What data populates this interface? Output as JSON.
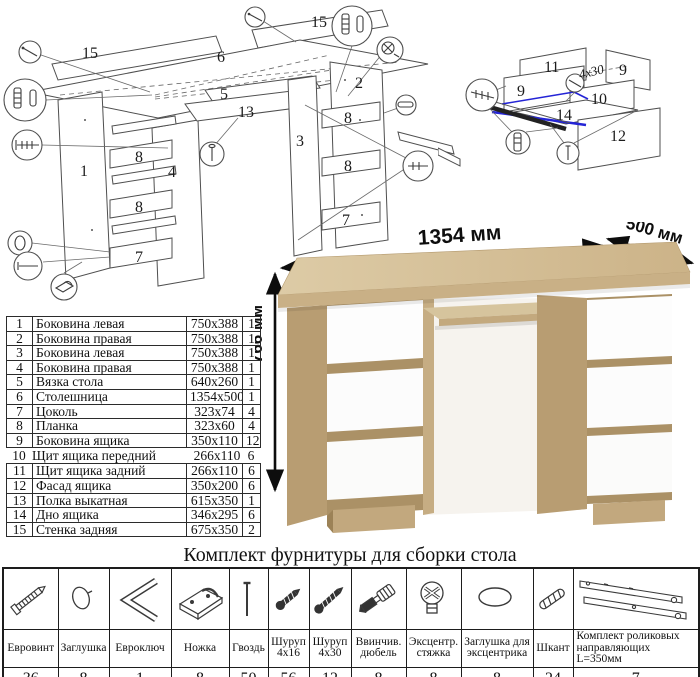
{
  "main_diagram": {
    "labels": {
      "p15_left": "15",
      "p15_right": "15",
      "p6": "6",
      "p5": "5",
      "p13": "13",
      "p1": "1",
      "p2": "2",
      "p3": "3",
      "p4": "4",
      "p7_left": "7",
      "p7_right": "7",
      "p8_a": "8",
      "p8_b": "8",
      "p8_c": "8",
      "p8_d": "8"
    }
  },
  "drawer_diagram": {
    "labels": {
      "p9_left": "9",
      "p9_right": "9",
      "p10": "10",
      "p11": "11",
      "p12": "12",
      "p14": "14",
      "screw_note": "4x30"
    }
  },
  "desk_view": {
    "dim_width": "1354 мм",
    "dim_depth": "500 мм",
    "dim_height": "766 мм"
  },
  "parts_table": {
    "rows": [
      {
        "num": "1",
        "name": "Боковина левая",
        "size": "750x388",
        "qty": "1"
      },
      {
        "num": "2",
        "name": "Боковина правая",
        "size": "750x388",
        "qty": "1"
      },
      {
        "num": "3",
        "name": "Боковина левая",
        "size": "750x388",
        "qty": "1"
      },
      {
        "num": "4",
        "name": "Боковина правая",
        "size": "750x388",
        "qty": "1"
      },
      {
        "num": "5",
        "name": "Вязка стола",
        "size": "640x260",
        "qty": "1"
      },
      {
        "num": "6",
        "name": "Столешница",
        "size": "1354x500",
        "qty": "1"
      },
      {
        "num": "7",
        "name": "Цоколь",
        "size": "323x74",
        "qty": "4"
      },
      {
        "num": "8",
        "name": "Планка",
        "size": "323x60",
        "qty": "4"
      },
      {
        "num": "9",
        "name": "Боковина ящика",
        "size": "350x110",
        "qty": "12"
      },
      {
        "num": "10",
        "name": "Щит ящика передний",
        "size": "266x110",
        "qty": "6"
      },
      {
        "num": "11",
        "name": "Щит ящика задний",
        "size": "266x110",
        "qty": "6"
      },
      {
        "num": "12",
        "name": "Фасад ящика",
        "size": "350x200",
        "qty": "6"
      },
      {
        "num": "13",
        "name": "Полка выкатная",
        "size": "615x350",
        "qty": "1"
      },
      {
        "num": "14",
        "name": "Дно ящика",
        "size": "346x295",
        "qty": "6"
      },
      {
        "num": "15",
        "name": "Стенка задняя",
        "size": "675x350",
        "qty": "2"
      }
    ]
  },
  "hardware": {
    "title": "Комплект фурнитуры для сборки стола",
    "items": [
      {
        "icon": "confirmat-screw-icon",
        "name": "Евровинт",
        "qty": "36"
      },
      {
        "icon": "cap-plug-icon",
        "name": "Заглушка",
        "qty": "8"
      },
      {
        "icon": "hex-key-icon",
        "name": "Евроключ",
        "qty": "1"
      },
      {
        "icon": "furniture-foot-icon",
        "name": "Ножка",
        "qty": "8"
      },
      {
        "icon": "nail-icon",
        "name": "Гвоздь",
        "qty": "50"
      },
      {
        "icon": "screw-small-icon",
        "name": "Шуруп 4x16",
        "qty": "56"
      },
      {
        "icon": "screw-large-icon",
        "name": "Шуруп 4x30",
        "qty": "12"
      },
      {
        "icon": "screw-in-dowel-icon",
        "name": "Ввинчив. дюбель",
        "qty": "8"
      },
      {
        "icon": "eccentric-cam-icon",
        "name": "Эксцентр. стяжка",
        "qty": "8"
      },
      {
        "icon": "cam-cover-icon",
        "name": "Заглушка для эксцентрика",
        "qty": "8"
      },
      {
        "icon": "wood-dowel-icon",
        "name": "Шкант",
        "qty": "24"
      },
      {
        "icon": "roller-guides-icon",
        "name": "Комплект роликовых направляющих L=350мм",
        "qty": "7"
      }
    ]
  },
  "colors": {
    "wood_top": "#d9c7a0",
    "wood_front": "#c9b086",
    "wood_side": "#b89d72",
    "drawer_white": "#fdfdfd",
    "highlight_blue": "#2424d6"
  }
}
